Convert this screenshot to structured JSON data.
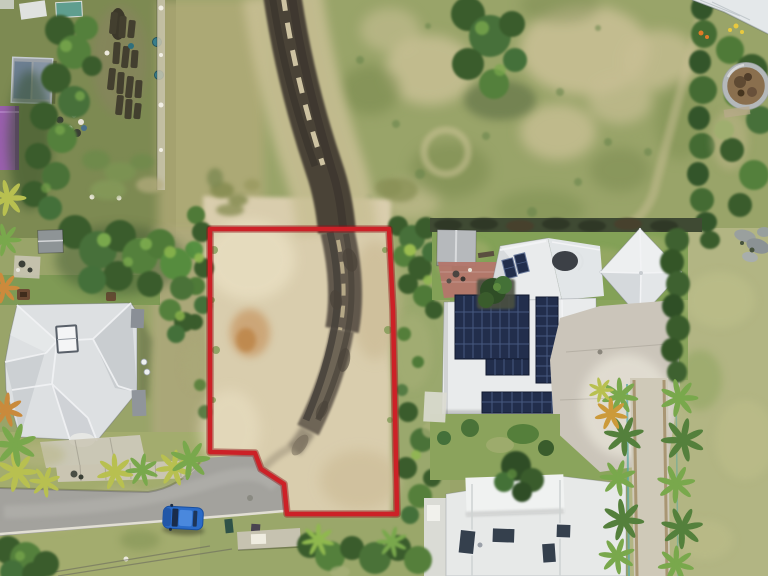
{
  "scene": {
    "title": "Aerial drone photo of a vacant land parcel outlined in red",
    "description": "Top-down drone photograph of a cleared sandy lot marked with a red boundary overlay. A muddy vehicle track curves through the lot and the grass field above it. A gray-roofed house sits to the left among trees; a white-roofed house with rooftop solar panels sits to the right; a white building is at bottom right. Top-left has vegetable garden beds, sheds and a purple building. A cul-de-sac road with a parked blue car enters at bottom-left, and a palm-lined walkway runs down the right side beside open lawn with a round water tank at top right.",
    "objects": [
      "vacant lot with red boundary overlay",
      "muddy vehicle track",
      "gray hipped-roof house (left)",
      "house with rooftop solar panels (right)",
      "pyramid roof section",
      "white-roofed building (bottom right)",
      "vegetable garden beds",
      "purple outbuilding",
      "round water tank",
      "cul-de-sac road",
      "parked blue car",
      "wheelie bins",
      "palm-lined walkway",
      "hedges, trees and lawns"
    ]
  },
  "lot": {
    "label": "red-outlined vacant parcel",
    "boundary_points": "210,229 389,229 393,310 397,514 287,514 284,484 261,469 255,453 210,452",
    "stroke_width": "4.5"
  },
  "colors": {
    "red_boundary": "#cc2127",
    "red_boundary_dark": "#8e1216",
    "grass_field": "#99a469",
    "grass_pale": "#b3ab79",
    "dry_patch": "#c8bf94",
    "lawn": "#b2b583",
    "verge": "#a3ac6e",
    "tree_dark": "#3a5c2c",
    "tree_mid": "#54803c",
    "tree_light": "#79a84c",
    "palm_yellow": "#b8c050",
    "hedge": "#33552a",
    "sand": "#d9cdad",
    "sand_light": "#e9dfc2",
    "mud": "#5c5348",
    "mud_dark": "#3c362e",
    "mud_streak": "#ddd2ae",
    "stain_orange": "#c08144",
    "road": "#a3a29d",
    "concrete": "#cac5b2",
    "curb": "#e9e6da",
    "path": "#cfc9b8",
    "roof_white": "#e9ebec",
    "roof_light": "#dde0e2",
    "roof_shed": "#b6b9bc",
    "solar_panel": "#222e4c",
    "solar_grid": "#4a5d85",
    "skylight": "#35404d",
    "car_blue": "#2a6bc8",
    "glass_dark": "#18263c",
    "purple": "#9a5fae",
    "brick": "#b4766b",
    "tank_rim": "#b4b8ba",
    "tank_interior": "#8a6f4e",
    "wall_dark": "#3f4a33",
    "soil": "#3e3a2c",
    "barrel_blue": "#3a7f8c",
    "fence_teal": "#58a8a2",
    "ridge_white": "#f2f3f5"
  }
}
